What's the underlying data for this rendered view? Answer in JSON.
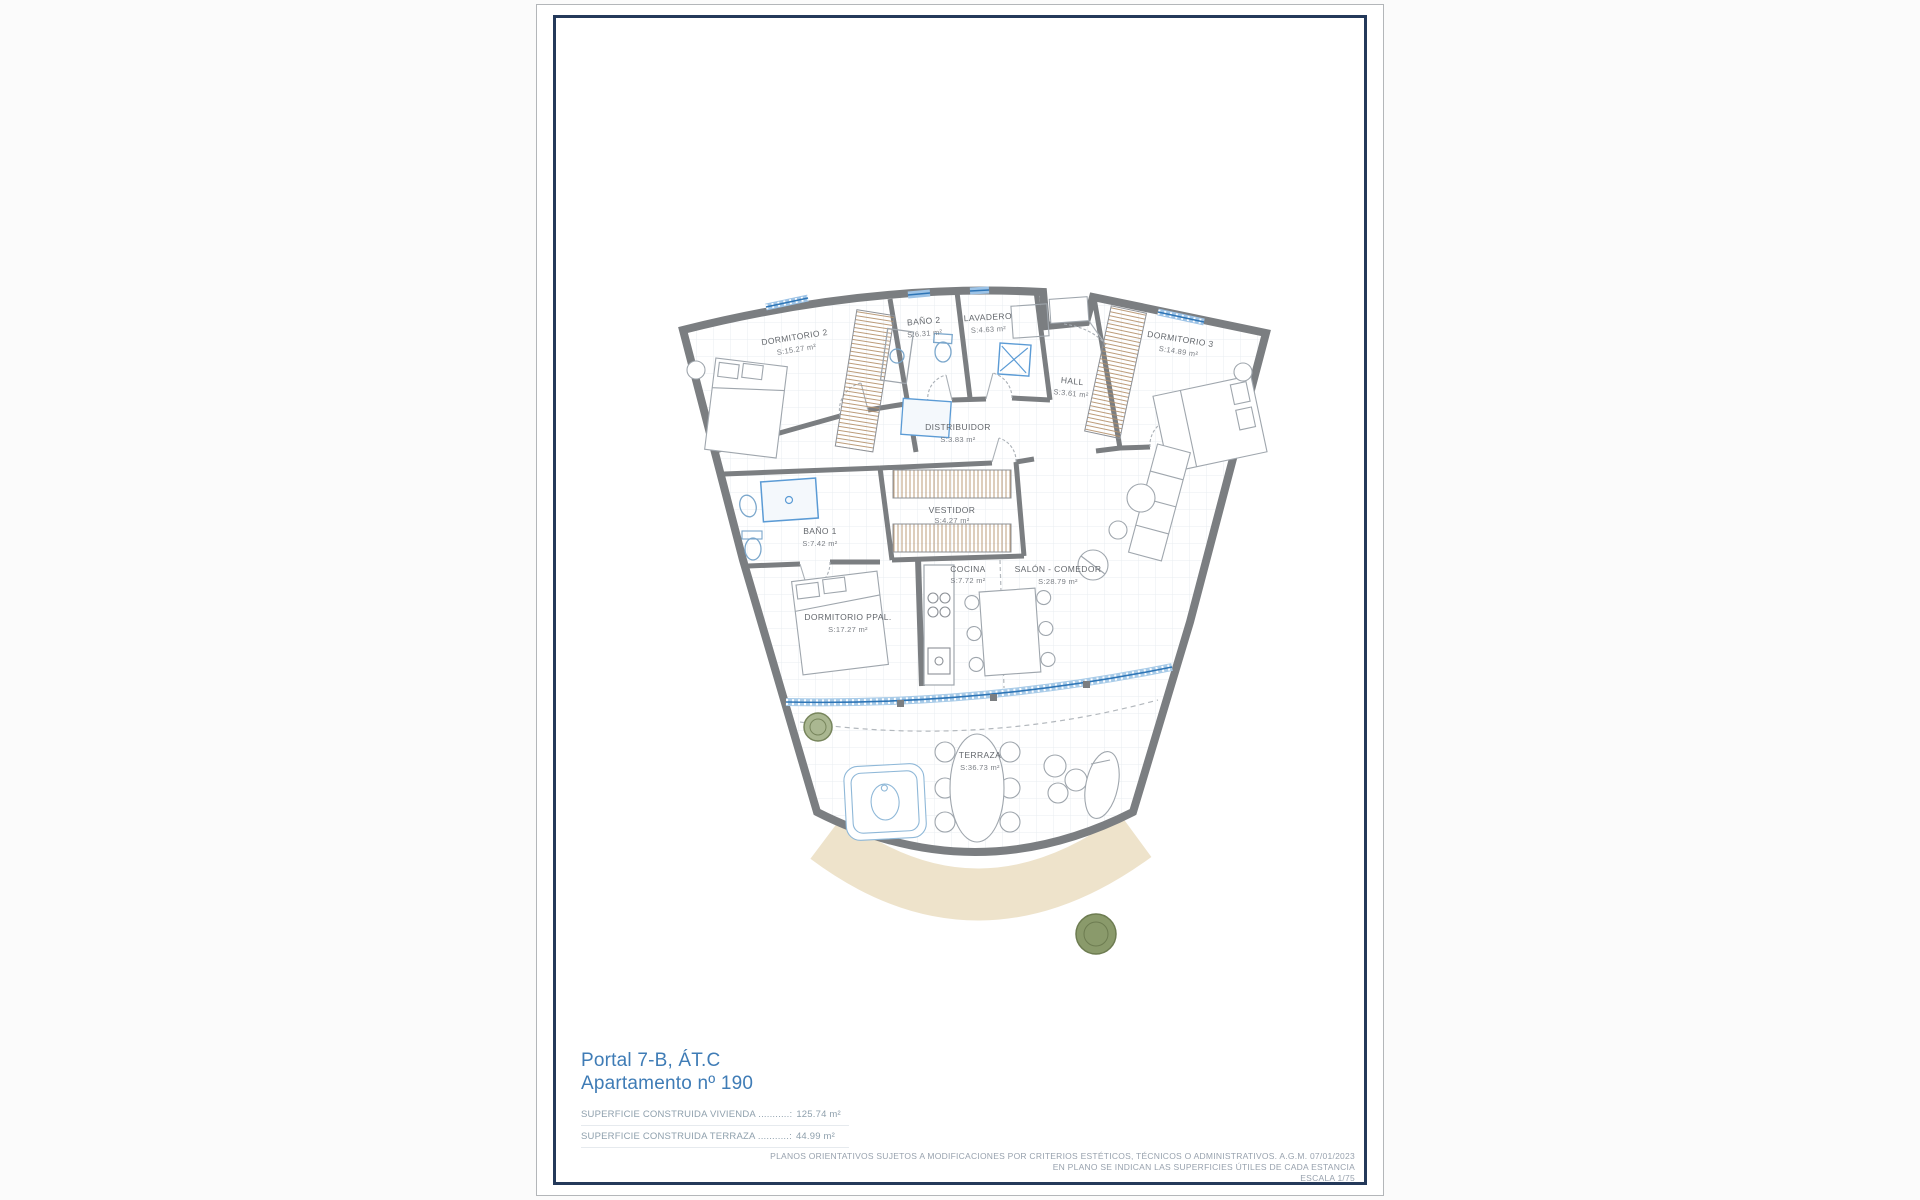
{
  "page": {
    "title_block": {
      "portal": "Portal 7-B, ÁT.C",
      "apartment": "Apartamento nº 190",
      "surfaces": [
        {
          "label": "SUPERFICIE CONSTRUIDA VIVIENDA ...........:",
          "value": "125.74 m²"
        },
        {
          "label": "SUPERFICIE CONSTRUIDA TERRAZA ...........:",
          "value": "44.99 m²"
        }
      ]
    },
    "disclaimer": {
      "line1": "PLANOS ORIENTATIVOS SUJETOS A MODIFICACIONES POR CRITERIOS ESTÉTICOS, TÉCNICOS O ADMINISTRATIVOS. A.G.M. 07/01/2023",
      "line2": "EN PLANO SE INDICAN LAS SUPERFICIES ÚTILES DE CADA ESTANCIA",
      "line3": "ESCALA 1/75"
    },
    "colors": {
      "frame": "#24395a",
      "title_blue": "#3f7cb6",
      "wall_gray": "#7b7e81",
      "window_blue": "#2e75b6",
      "wardrobe_tan": "#b5916b",
      "terrace_sand": "#eee3cb",
      "plant_olive": "#93a375"
    }
  },
  "floorplan": {
    "rooms": [
      {
        "name": "DORMITORIO 2",
        "area": "S:15.27 m²"
      },
      {
        "name": "BAÑO 2",
        "area": "S:6.31 m²"
      },
      {
        "name": "LAVADERO",
        "area": "S:4.63 m²"
      },
      {
        "name": "HALL",
        "area": "S:3.61 m²"
      },
      {
        "name": "DORMITORIO 3",
        "area": "S:14.89 m²"
      },
      {
        "name": "DISTRIBUIDOR",
        "area": "S:3.83 m²"
      },
      {
        "name": "VESTIDOR",
        "area": "S:4.27 m²"
      },
      {
        "name": "BAÑO 1",
        "area": "S:7.42 m²"
      },
      {
        "name": "DORMITORIO PPAL.",
        "area": "S:17.27 m²"
      },
      {
        "name": "COCINA",
        "area": "S:7.72 m²"
      },
      {
        "name": "SALÓN - COMEDOR",
        "area": "S:28.79 m²"
      },
      {
        "name": "TERRAZA",
        "area": "S:36.73 m²"
      }
    ]
  }
}
